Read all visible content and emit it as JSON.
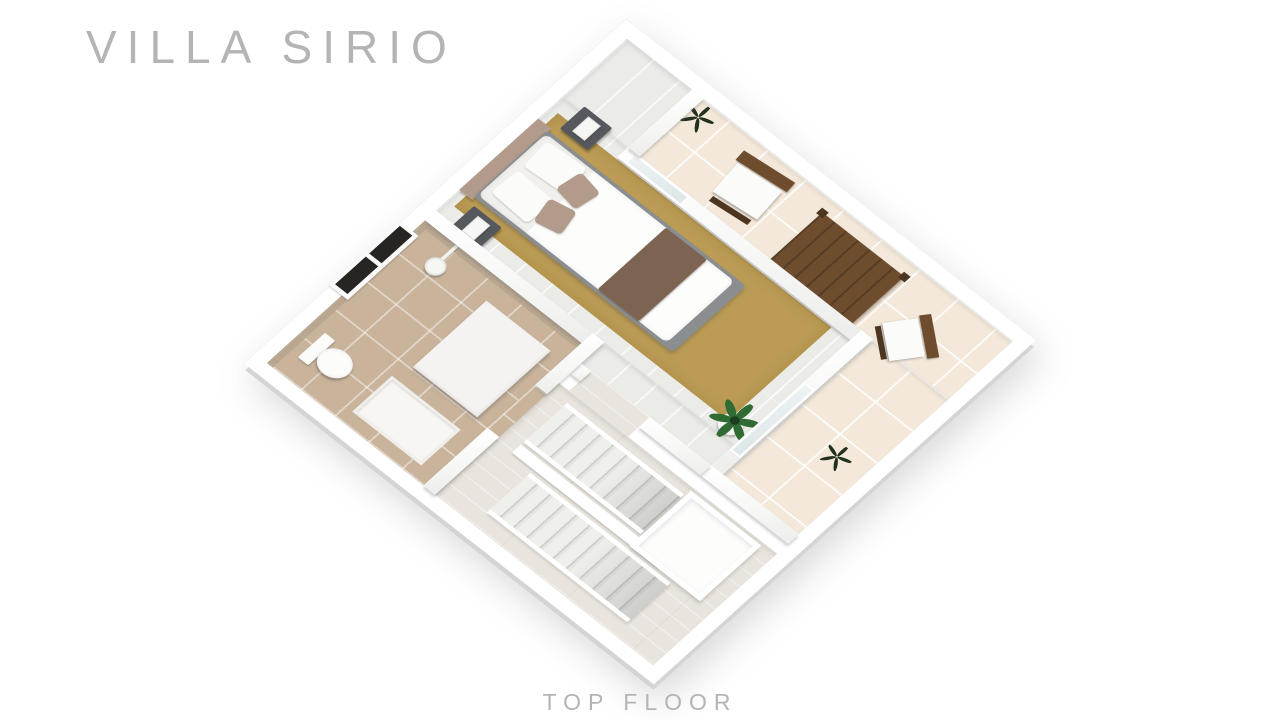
{
  "header": {
    "title": "VILLA SIRIO"
  },
  "footer": {
    "floor_label": "TOP FLOOR"
  },
  "colors": {
    "bg": "#ffffff",
    "label": "#b4b4b4",
    "terrace-tile": "#f3e8da",
    "bath-tile": "#c9b39b",
    "bed-floor": "#ebebe8",
    "hall-wood": "#e9e5de",
    "rug": "#bc9c54",
    "runner": "#7d6452",
    "headboard": "#b29b8b",
    "bed-base": "#8a8e91",
    "nightstand": "#55595d",
    "wood": "#6e4c2e",
    "wood-dark": "#4e3520",
    "green": "#2f6b33",
    "green-dark": "#22301e",
    "window-glass": "#262522",
    "door-glass": "#dce6e8",
    "accent-wall": "#b6a58e"
  }
}
